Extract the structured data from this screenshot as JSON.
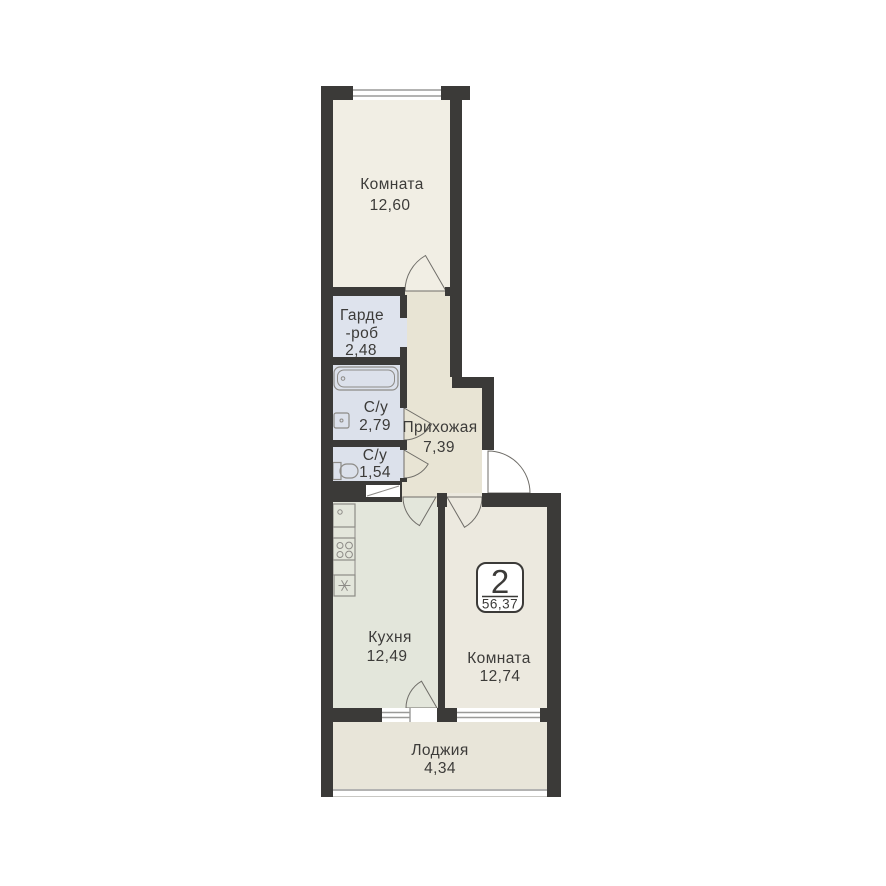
{
  "plan": {
    "type": "apartment-floor-plan",
    "badge": {
      "rooms_count": "2",
      "total_area": "56,37"
    },
    "rooms": {
      "room_top": {
        "label": "Комната",
        "area": "12,60"
      },
      "wardrobe": {
        "label1": "Гарде",
        "label2": "-роб",
        "area": "2,48"
      },
      "bathroom": {
        "label": "С/у",
        "area": "2,79"
      },
      "wc": {
        "label": "С/у",
        "area": "1,54"
      },
      "hallway": {
        "label": "Прихожая",
        "area": "7,39"
      },
      "kitchen": {
        "label": "Кухня",
        "area": "12,49"
      },
      "room_bottom": {
        "label": "Комната",
        "area": "12,74"
      },
      "loggia": {
        "label": "Лоджия",
        "area": "4,34"
      }
    },
    "colors": {
      "wall": "#3b3a38",
      "room_top": "#f1eee4",
      "room_bottom": "#ece9df",
      "kitchen": "#e3e6db",
      "hallway": "#e8e4d4",
      "wet_room": "#dce1eb",
      "wardrobe": "#dee3ed",
      "loggia": "#e8e5d9",
      "fixture_stroke": "#8d8b87",
      "text": "#3c3b39",
      "background": "#ffffff"
    },
    "icons": [
      "bathtub-icon",
      "washbasin-icon",
      "toilet-icon",
      "kitchen-sink-icon",
      "stove-icon",
      "fridge-icon",
      "window-icon",
      "door-arc-icon"
    ]
  }
}
